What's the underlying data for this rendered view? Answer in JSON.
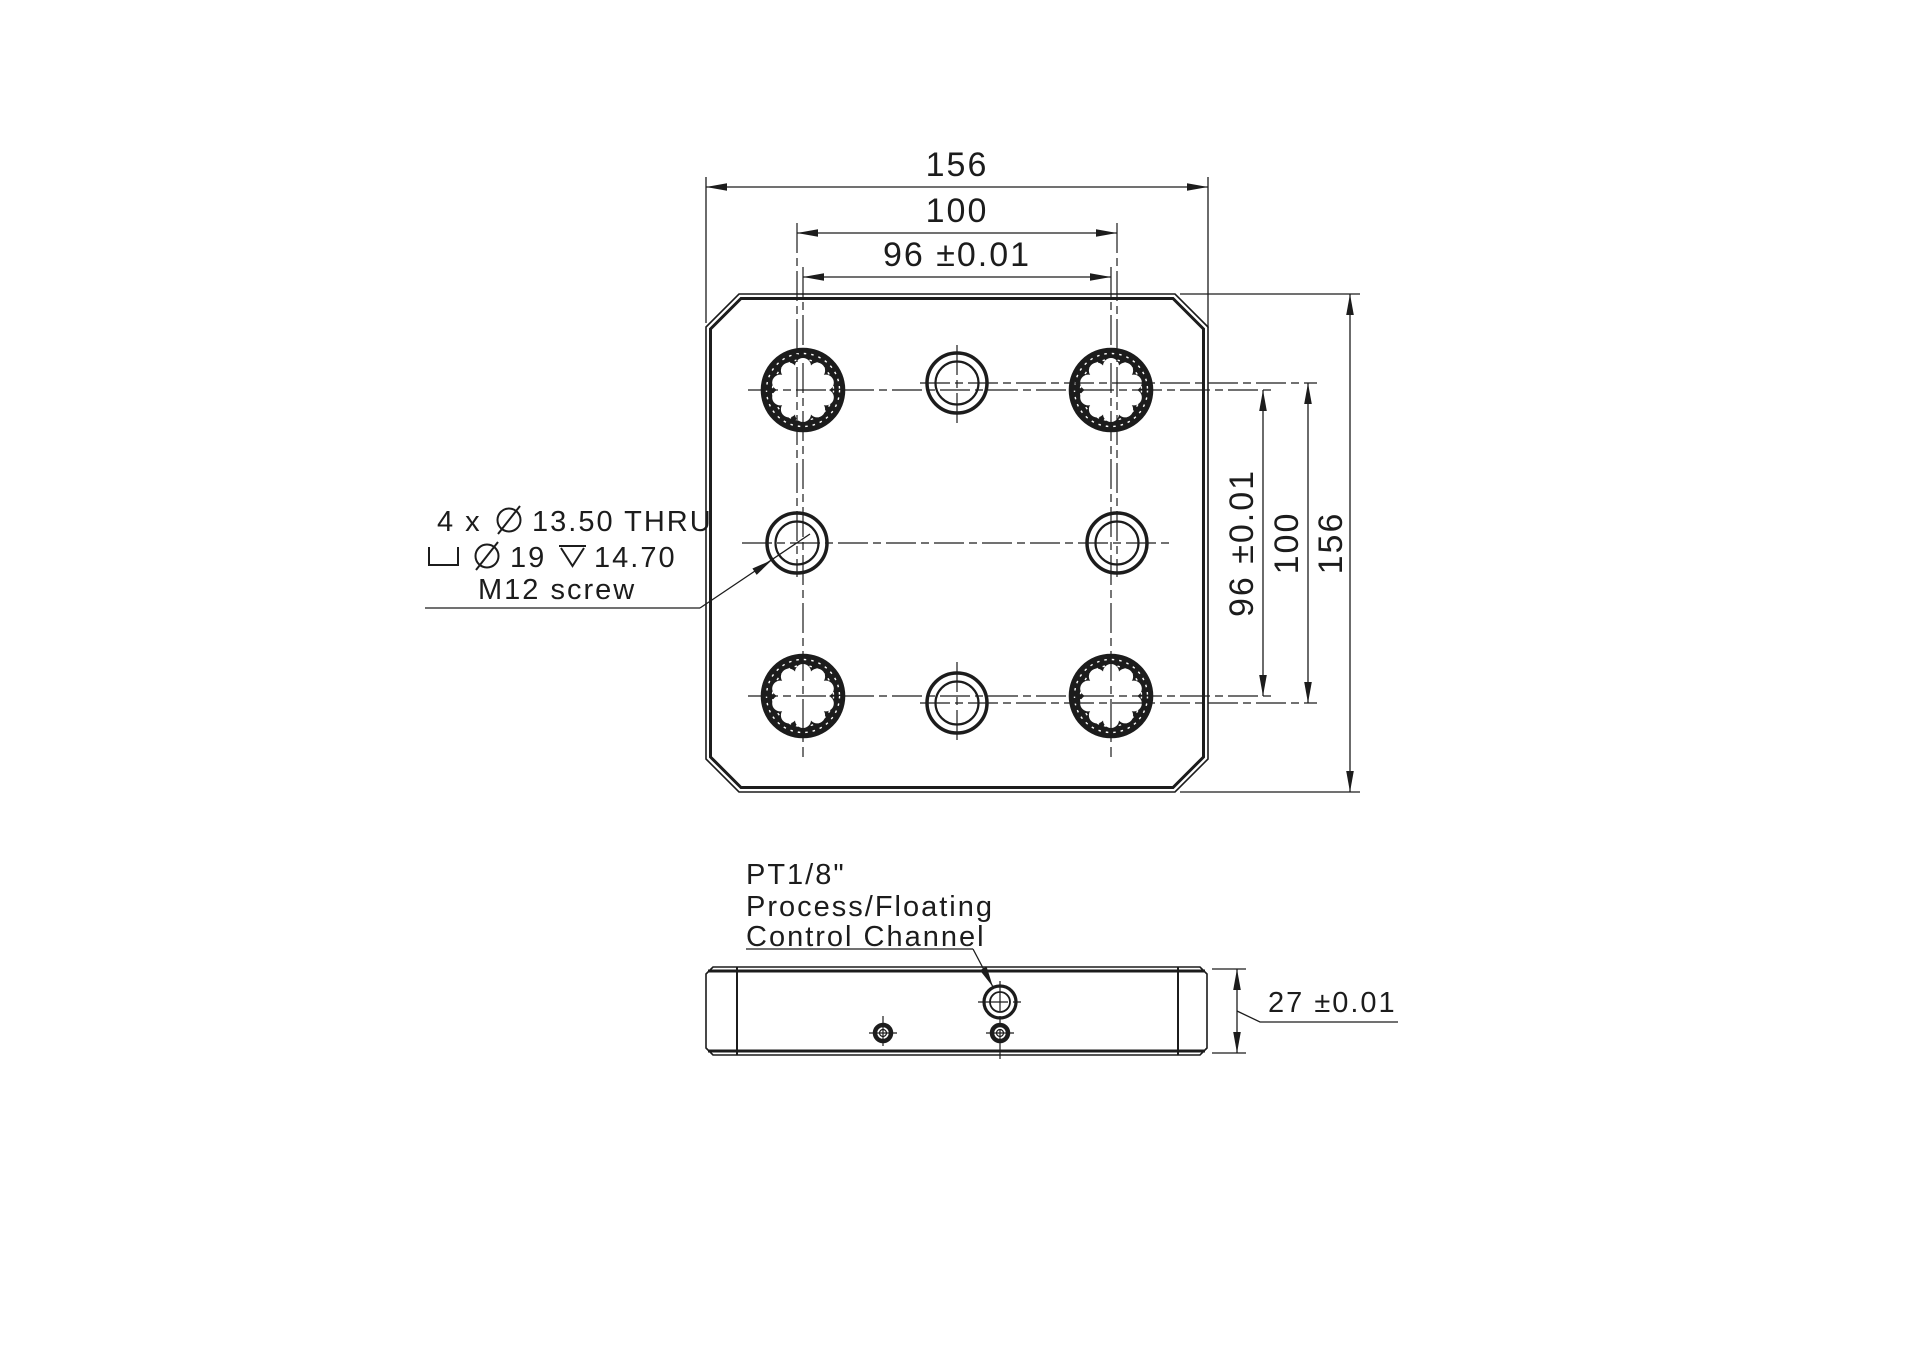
{
  "colors": {
    "ink": "#1c1c1c",
    "background": "#ffffff"
  },
  "top_view": {
    "dim_width_overall": "156",
    "dim_width_hole_circle": "100",
    "dim_width_lock_holes": "96 ±0.01",
    "dim_height_lock_holes": "96 ±0.01",
    "dim_height_hole_circle": "100",
    "dim_height_overall": "156",
    "callout": {
      "line1_prefix": "4 x",
      "line1_value": "13.50 THRU",
      "line2_diameter_value": "19",
      "line2_depth_value": "14.70",
      "line3": "M12 screw"
    }
  },
  "side_view": {
    "port_label_line1": "PT1/8\"",
    "port_label_line2": "Process/Floating",
    "port_label_line3": "Control Channel",
    "dim_thickness": "27 ±0.01"
  }
}
